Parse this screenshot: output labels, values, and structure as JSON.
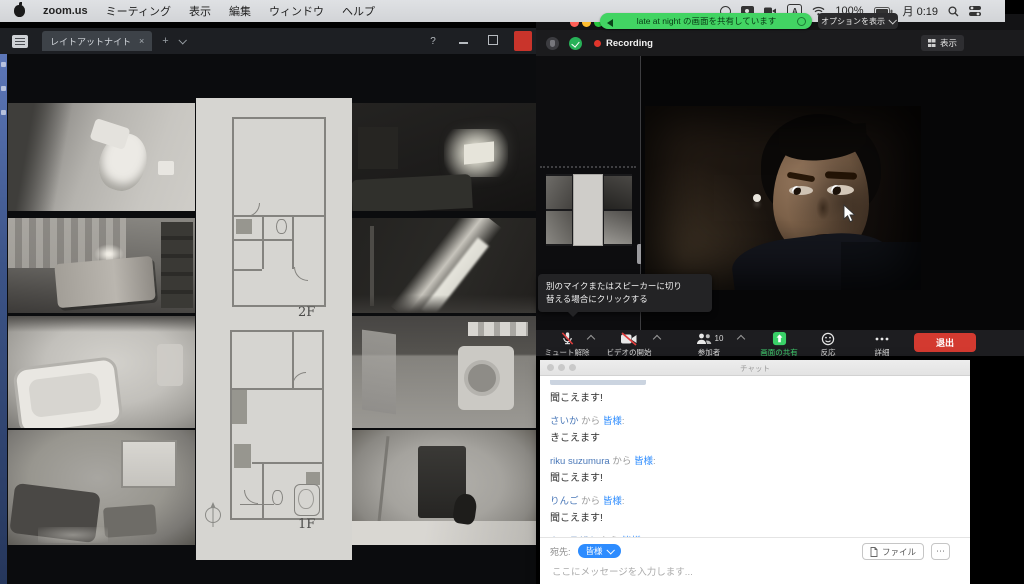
{
  "menubar": {
    "app_name": "zoom.us",
    "menus": [
      "ミーティング",
      "表示",
      "編集",
      "ウィンドウ",
      "ヘルプ"
    ],
    "ime": "A",
    "battery_percent": "100%",
    "clock": "月 0:19"
  },
  "share_banner": {
    "text": "late at night の画面を共有しています",
    "options_label": "オプションを表示"
  },
  "monitor_app": {
    "tab_title": "レイトアットナイト",
    "tab_close": "×",
    "new_tab": "+",
    "help": "?",
    "floor_upper": "2F",
    "floor_lower": "1F"
  },
  "zoom_meeting": {
    "recording_label": "Recording",
    "view_label": "表示",
    "tooltip_line1": "別のマイクまたはスピーカーに切り",
    "tooltip_line2": "替える場合にクリックする",
    "toolbar": {
      "mute": "ミュート解除",
      "video": "ビデオの開始",
      "participants": "参加者",
      "participants_count": "10",
      "share": "画面の共有",
      "reactions": "反応",
      "more": "詳細",
      "leave": "退出"
    }
  },
  "chat": {
    "window_title": "チャット",
    "from_word": "から",
    "colon": ":",
    "messages": [
      {
        "sender": "",
        "recipient": "皆様",
        "body": "聞こえます!"
      },
      {
        "sender": "さいか",
        "recipient": "皆様",
        "body": "きこえます"
      },
      {
        "sender": "riku suzumura",
        "recipient": "皆様",
        "body": "聞こえます!"
      },
      {
        "sender": "りんご",
        "recipient": "皆様",
        "body": "聞こえます!"
      },
      {
        "sender": "キュラザキ",
        "recipient": "皆様",
        "body": "聞こえます"
      }
    ],
    "to_label": "宛先:",
    "to_value": "皆様",
    "file_button": "ファイル",
    "more_button": "⋯",
    "input_placeholder": "ここにメッセージを入力します..."
  }
}
